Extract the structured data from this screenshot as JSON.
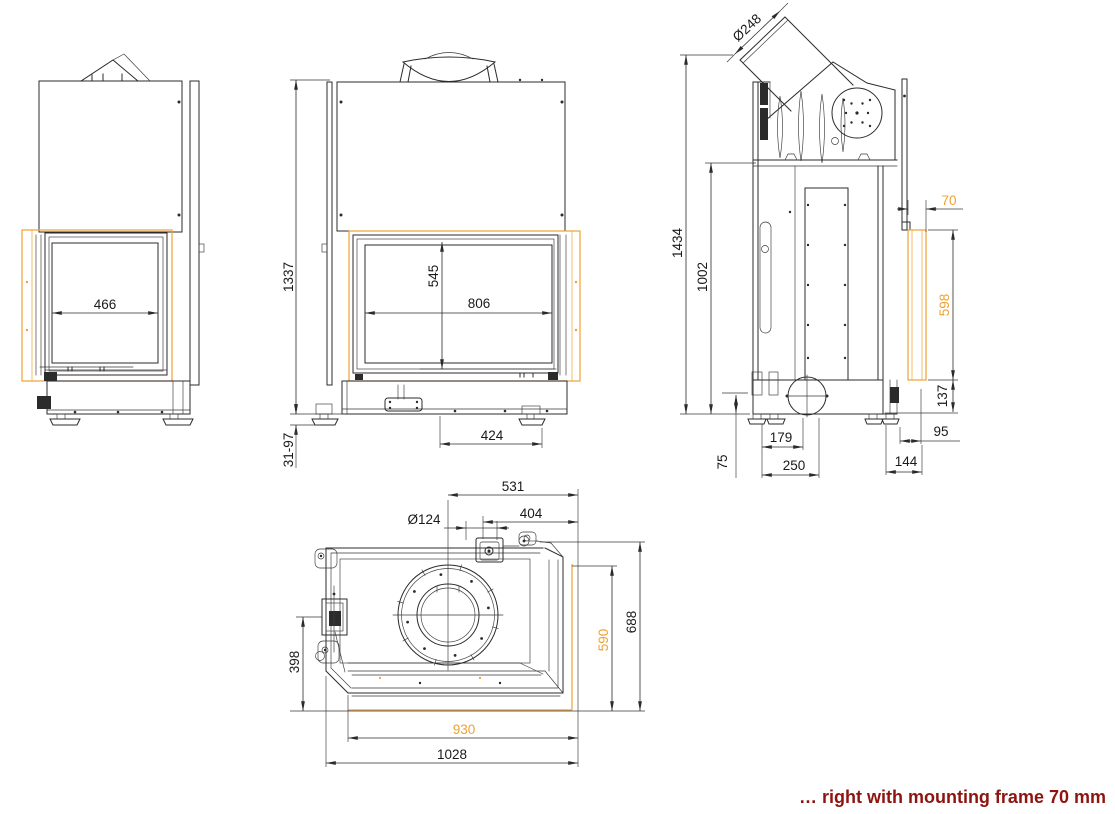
{
  "caption": {
    "text": "… right with mounting frame 70 mm"
  },
  "colors": {
    "line": "#2b2b2b",
    "accent_orange": "#f0a032",
    "caption_red": "#8e1410"
  },
  "views": {
    "side_a": {
      "glass_width": "466"
    },
    "front": {
      "total_height": "1337",
      "glass_height": "545",
      "glass_width": "806",
      "base_width": "424",
      "leveling_range": "31-97"
    },
    "side_b": {
      "flue_diameter": "Ø248",
      "total_height": "1434",
      "body_height": "1002",
      "frame_depth": "70",
      "frame_height": "598",
      "base_height": "137",
      "foot_height": "75",
      "air_center": "179",
      "air_edge": "250",
      "front_gap": "95",
      "base_front": "144"
    },
    "top": {
      "flue_center": "531",
      "outlet_offset": "404",
      "outlet_diameter": "Ø124",
      "hinge_depth": "398",
      "frame_side": "590",
      "total_depth": "688",
      "frame_front": "930",
      "total_width": "1028"
    }
  }
}
